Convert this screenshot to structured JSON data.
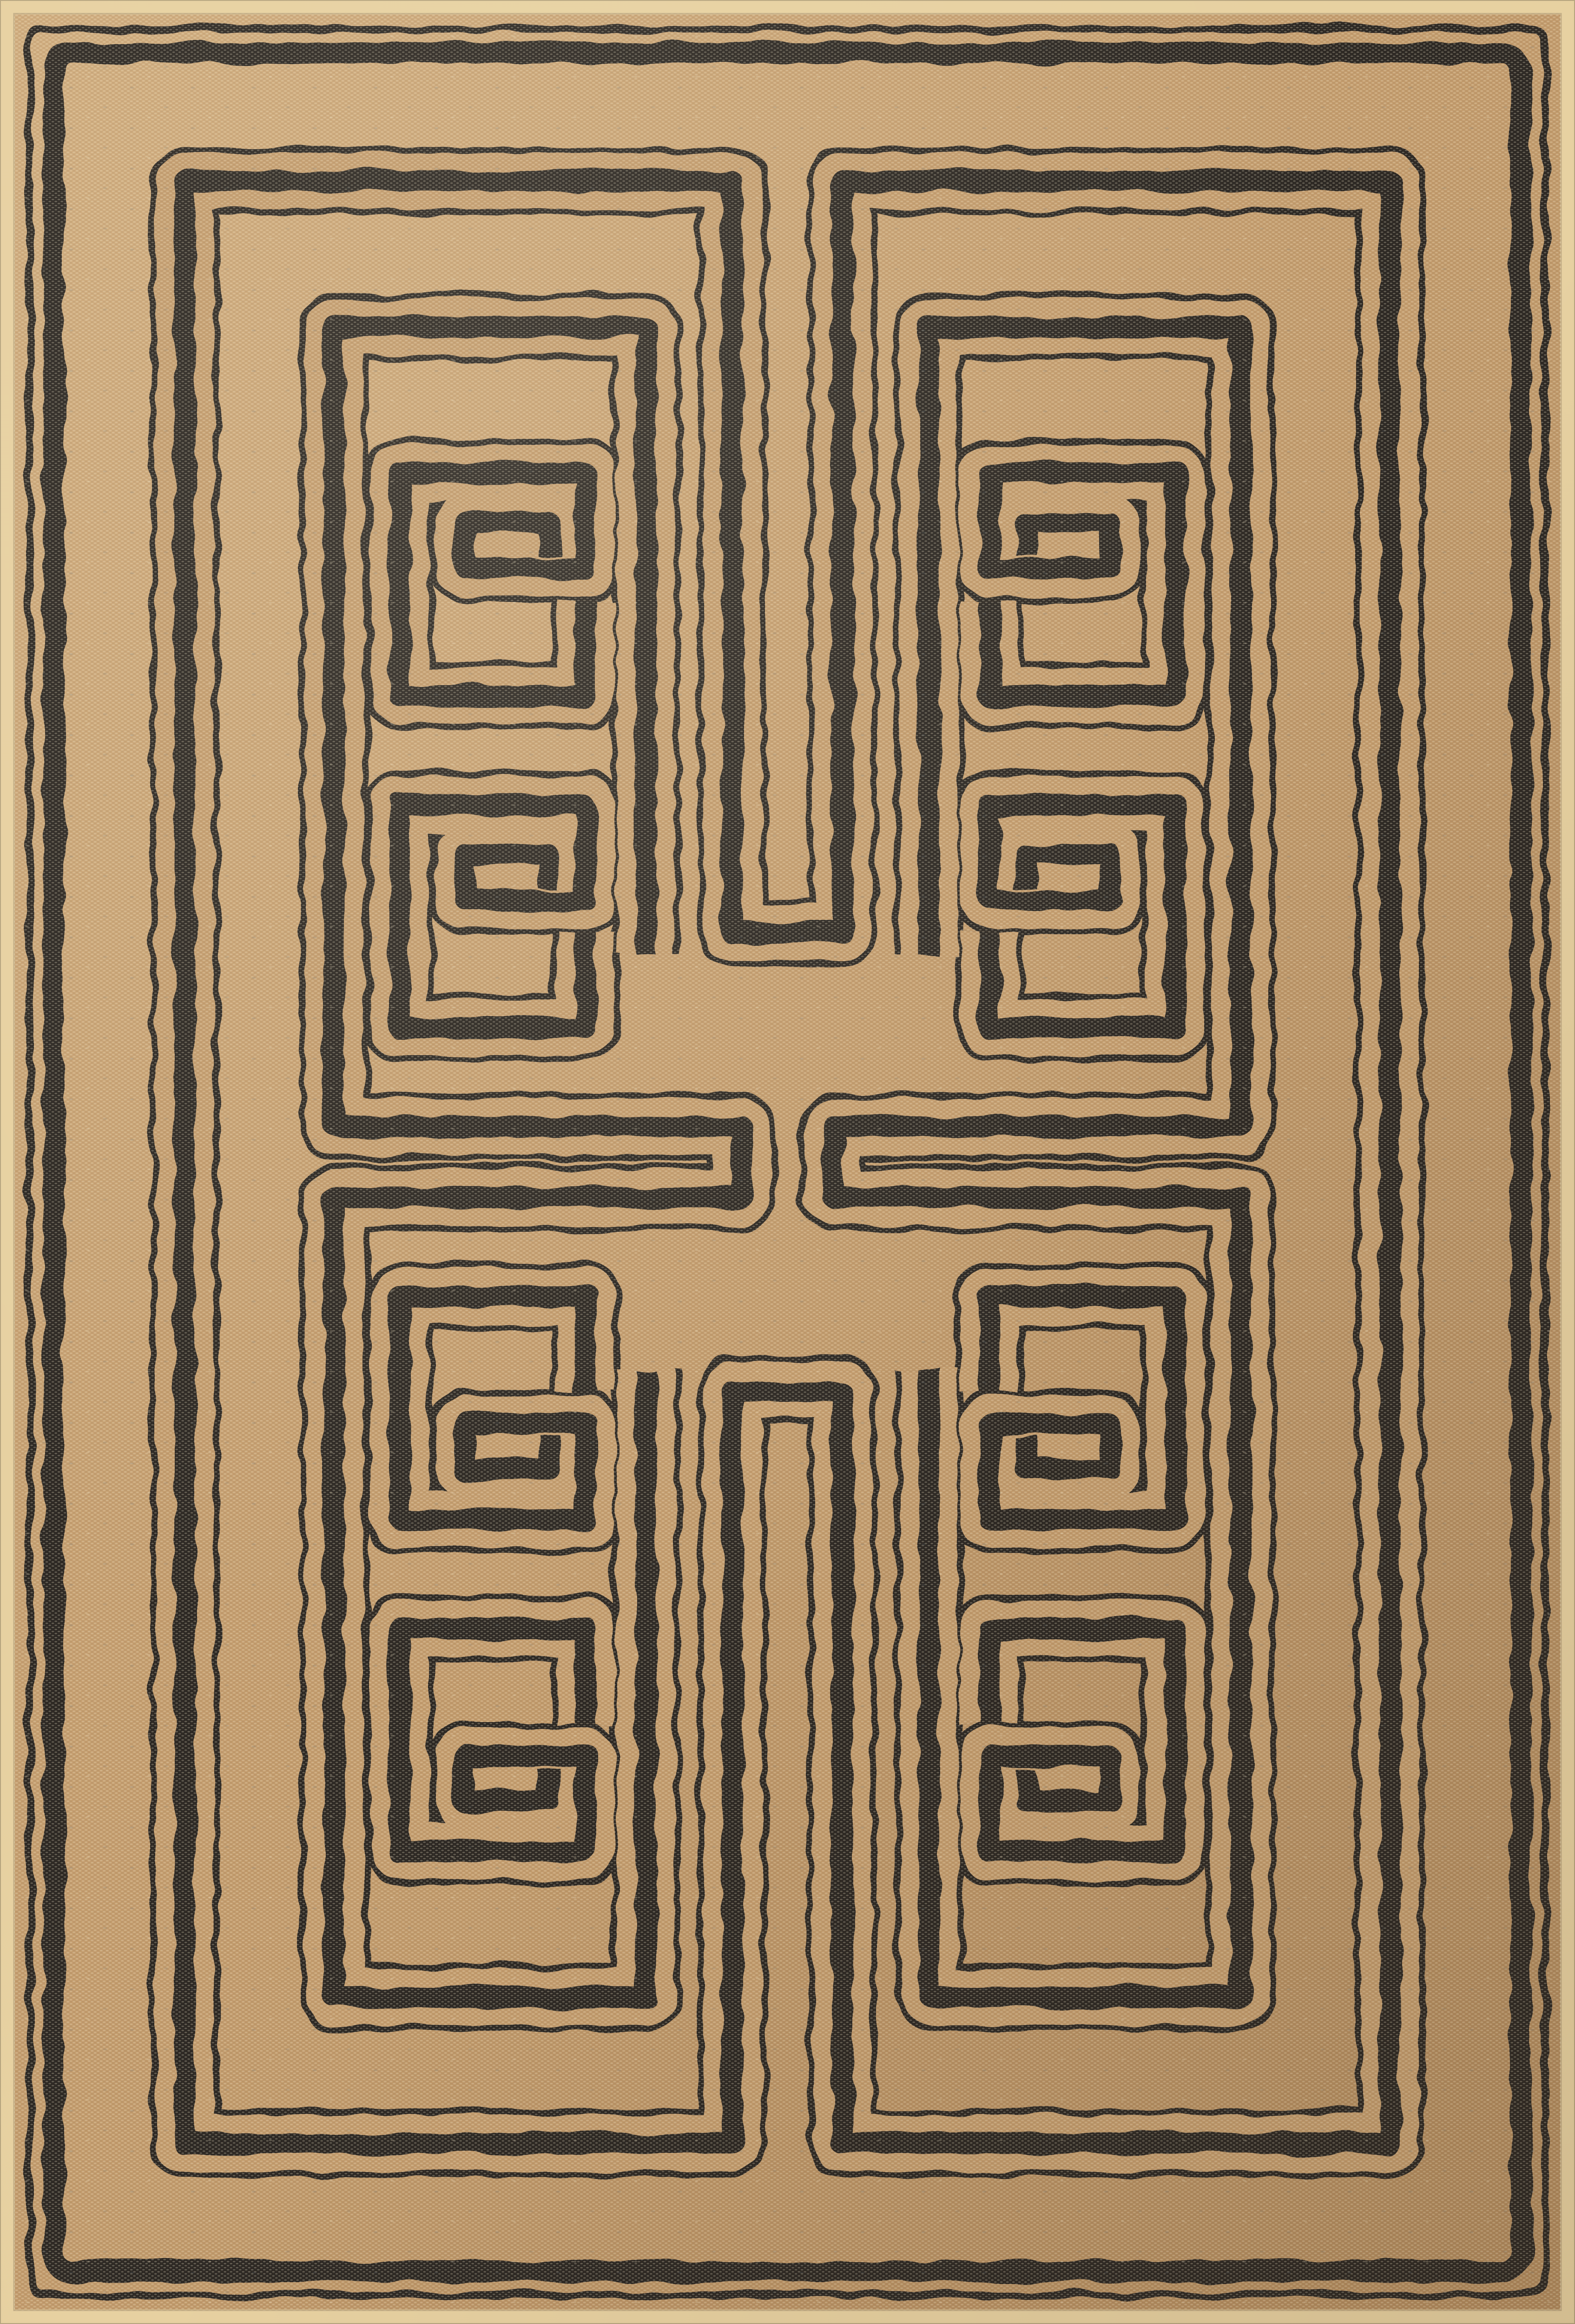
{
  "image": {
    "type": "product photograph",
    "subject": "Rectangular flatweave area rug seen flat from above, filling the frame",
    "description": "Top-down photograph of a tan flatweave rug patterned with a charcoal Greek-key maze: a thin-and-thick outer border with rounded corners, four mirror-image quadrant spirals that hook toward a central cross, two small rectangular key motifs inside each quadrant, tall key stubs at top and bottom center, paired hairpin lines meeting at the middle, and a narrow cream bound selvage around the edge. Every dark band is flanked by thin pinstripes and has a slightly distressed woven texture.",
    "pattern": {
      "name": "Greek key / labyrinth maze",
      "quadrant_count": 4,
      "small_spiral_motifs_per_quadrant": 2,
      "line_style": "thick charcoal bands flanked by thin pinstripes, edges distressed by the weave",
      "border": "thin outer pinstripe with a heavier inner band, softly rounded corners",
      "edge": "narrow cream bound selvage strip",
      "symmetry": "mirrored left-right and top-bottom about the rug center"
    },
    "colors": {
      "field_tan": "#c39c6d",
      "field_tan_light": "#cfab7c",
      "field_tan_deep": "#b28b5e",
      "line_charcoal": "#2b2521",
      "selvage_cream": "#e7d1a1",
      "selvage_edge": "#c3ad85",
      "weave_light": "#f0e3c5",
      "weave_dark": "#6e5a42",
      "steel_fleck": "#63727a"
    }
  }
}
